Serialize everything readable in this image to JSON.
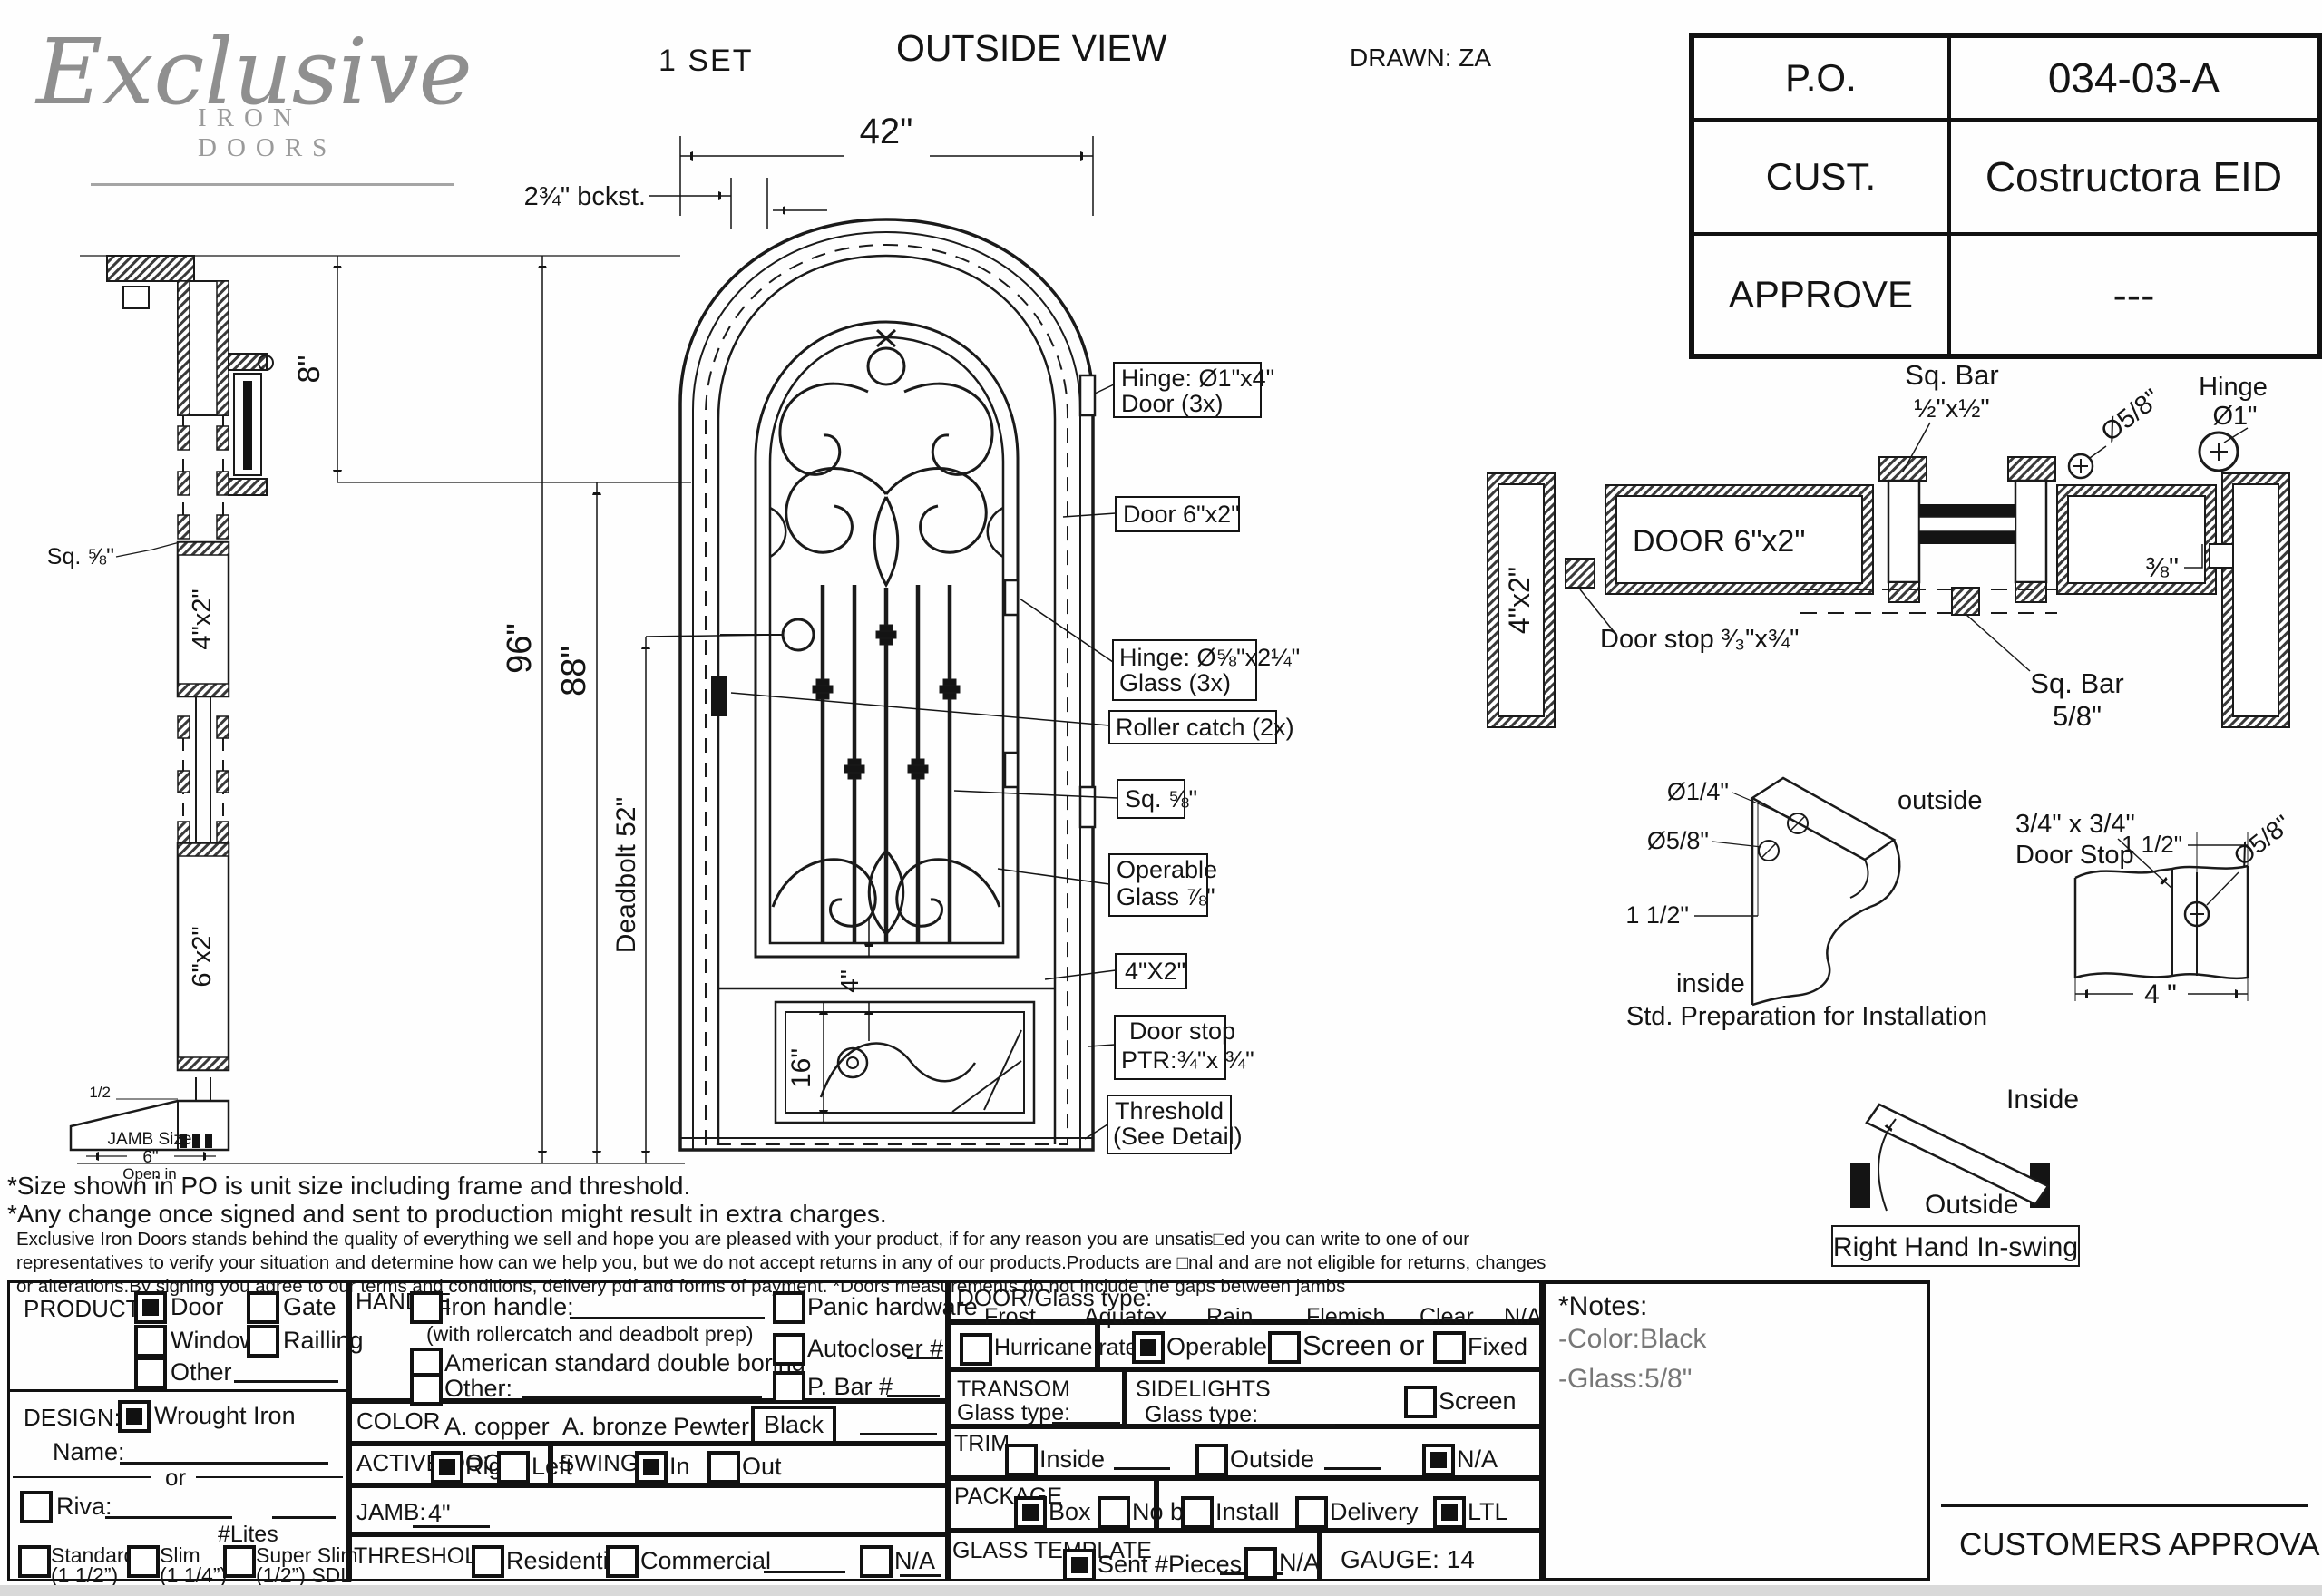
{
  "header": {
    "logo_main": "Exclusive",
    "logo_sub": "IRON DOORS",
    "set_count": "1  SET",
    "view_title": "OUTSIDE VIEW",
    "drawn_by": "DRAWN: ZA",
    "po_label": "P.O.",
    "po_value": "034-03-A",
    "cust_label": "CUST.",
    "cust_value": "Costructora EID",
    "approve_label": "APPROVE",
    "approve_value": "---"
  },
  "drawing": {
    "dims": {
      "width": "42\"",
      "backset": "2¾\" bckst.",
      "arch": "8\"",
      "unit_height": "96\"",
      "door_height": "88\"",
      "deadbolt": "Deadbolt 52\"",
      "panel16": "16\"",
      "rail4": "4\""
    },
    "callouts": {
      "hinge_door_1": "Hinge: Ø1\"x4\"",
      "hinge_door_2": "Door (3x)",
      "door_tube": "Door 6\"x2\"",
      "hinge_glass_1": "Hinge: Ø⅝\"x2¼\"",
      "hinge_glass_2": "Glass (3x)",
      "roller": "Roller catch  (2x)",
      "sq_bar": "Sq. ⅝\"",
      "operable_1": "Operable",
      "operable_2": "Glass ⅞\"",
      "rail_4x2": "4\"X2\"",
      "door_stop_1": "Door stop",
      "door_stop_2": "PTR:¾\"x ¾\"",
      "threshold_1": "Threshold",
      "threshold_2": "(See Detail)"
    },
    "jamb": {
      "sq_label": "Sq. ⅝\"",
      "label_4x2": "4\"x2\"",
      "label_6x2": "6\"x2\"",
      "half": "1/2",
      "size_1": "JAMB Size",
      "size_2": "6\"",
      "size_3": "Open in"
    },
    "section": {
      "sq_bar_1": "Sq. Bar",
      "sq_bar_2": "½\"x½\"",
      "dia58": "Ø5/8\"",
      "hinge_1": "Hinge",
      "hinge_2": "Ø1\"",
      "door_label": "DOOR 6\"x2\"",
      "jamb_label": "4\"x2\"",
      "frac38": "⅜\"",
      "sq_bar58_1": "Sq. Bar",
      "sq_bar58_2": "5/8\"",
      "door_stop": "Door stop ³⁄₃\"x¾\""
    },
    "prep": {
      "dia14": "Ø1/4\"",
      "dia58": "Ø5/8\"",
      "dim112": "1 1/2\"",
      "outside": "outside",
      "inside": "inside",
      "caption": "Std. Preparation for Installation"
    },
    "stop": {
      "title_1": "3/4\" x 3/4\"",
      "title_2": "Door Stop",
      "dim112": "1 1/2\"",
      "dia58": "Ø5/8\"",
      "dim4": "4 \""
    },
    "swing": {
      "inside": "Inside",
      "outside": "Outside",
      "caption": "Right Hand In-swing"
    }
  },
  "notes": {
    "line1": "*Size shown in PO is unit size including frame and threshold.",
    "line2": "*Any change once signed and sent to production might result in extra charges.",
    "para1": "Exclusive Iron Doors stands behind the quality of everything we sell and hope you are pleased with your product, if for any reason you are unsatis□ed you can write to one of our",
    "para2": "representatives to verify your situation and determine how can we help you, but we do not accept returns in any of our products.Products are □nal and are not eligible for returns, changes",
    "para3": "or alterations.By signing you agree to our terms and conditions, delivery pdf and forms of payment. *Doors measurements do not include the gaps between jambs"
  },
  "form": {
    "product": {
      "label": "PRODUCT:",
      "door": "Door",
      "gate": "Gate",
      "window": "Window",
      "railing": "Railling",
      "other": "Other"
    },
    "design": {
      "label": "DESIGN:",
      "wrought": "Wrought Iron",
      "name": "Name:",
      "or": "or",
      "riva": "Riva:",
      "lites": "#Lites",
      "standard1": "Standard",
      "standard2": "(1 1/2”)",
      "slim1": "Slim",
      "slim2": "(1 1/4”)",
      "super1": "Super Slim",
      "super2": "(1/2”) SDL"
    },
    "handle": {
      "label": "HANDLE",
      "iron": "Iron handle:",
      "note": "(with rollercatch and deadbolt prep)",
      "american": "American standard double boring",
      "other": "Other:",
      "panic": "Panic hardware",
      "auto": "Autocloser #",
      "pbar": "P. Bar #"
    },
    "color": {
      "label": "COLOR",
      "copper": "A. copper",
      "bronze": "A. bronze",
      "pewter": "Pewter",
      "black": "Black"
    },
    "active": {
      "label": "ACTIVE DOOR",
      "right": "Right",
      "left": "Left"
    },
    "swing": {
      "label": "SWING",
      "in": "In",
      "out": "Out"
    },
    "jamb": {
      "label": "JAMB:",
      "value": "4\""
    },
    "threshold": {
      "label": "THRESHOLD",
      "res": "Residential",
      "com": "Commercial",
      "na": "N/A"
    },
    "glass": {
      "label": "DOOR/Glass type:",
      "t1": "Frost",
      "t2": "Aquatex",
      "t3": "Rain",
      "t4": "Flemish",
      "t5": "Clear",
      "t6": "N/A",
      "hurricane": "Hurricane rated",
      "operable": "Operable",
      "screen": "Screen or",
      "fixed": "Fixed"
    },
    "transom": {
      "label": "TRANSOM",
      "glass": "Glass type:"
    },
    "side": {
      "label": "SIDELIGHTS",
      "glass": "Glass type:",
      "screen": "Screen"
    },
    "trim": {
      "label": "TRIM",
      "inside": "Inside",
      "outside": "Outside",
      "na": "N/A"
    },
    "pkg": {
      "label": "PACKAGE",
      "box": "Box",
      "nobox": "No box",
      "install": "Install",
      "delivery": "Delivery",
      "ltl": "LTL"
    },
    "template": {
      "label": "GLASS TEMPLATE",
      "sent": "Sent #Pieces:",
      "na": "N/A"
    },
    "gauge": "GAUGE: 14",
    "notes": {
      "title": "*Notes:",
      "c": "-Color:Black",
      "g": "-Glass:5/8\""
    },
    "approval": "CUSTOMERS APPROVAL"
  },
  "checks": {
    "product_door": true,
    "product_gate": false,
    "product_window": false,
    "product_railing": false,
    "product_other": false,
    "design_wrought": true,
    "riva": false,
    "std": false,
    "slim": false,
    "super": false,
    "iron": false,
    "american": false,
    "handle_other": false,
    "panic": false,
    "auto": false,
    "pbar": false,
    "hurricane": false,
    "operable": true,
    "screen": false,
    "fixed": false,
    "active_right": true,
    "active_left": false,
    "swing_in": true,
    "swing_out": false,
    "th_res": false,
    "th_com": false,
    "th_na": false,
    "side_screen": false,
    "trim_in": false,
    "trim_out": false,
    "trim_na": true,
    "box": true,
    "nobox": false,
    "install": false,
    "delivery": false,
    "ltl": true,
    "sent": true,
    "tmpl_na": false
  },
  "colors": {
    "ink": "#141414",
    "logo_gray": "#8f8f8f"
  }
}
